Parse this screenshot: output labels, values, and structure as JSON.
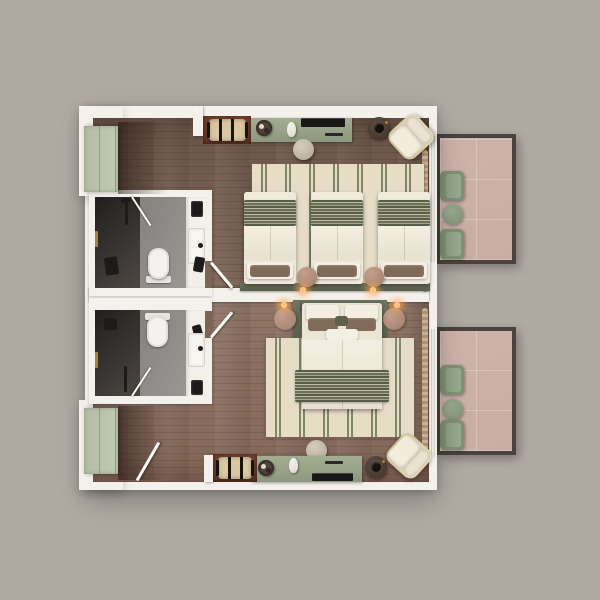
{
  "scene": {
    "kind": "hotel floor plan, top-down 3D render, no text labels",
    "units": [
      {
        "id": "room-upper",
        "type": "triple guestroom",
        "zones": [
          "entry with wardrobe",
          "bathroom",
          "bedroom with three single beds",
          "balcony"
        ],
        "furniture": [
          "luggage-rack",
          "console-desk",
          "tv",
          "coffee-tray",
          "kettle",
          "desk-stool",
          "round-side-table",
          "lounge-chair",
          "striped-area-rug",
          "single-bed",
          "single-bed",
          "single-bed",
          "bedside-pouf",
          "bedside-pouf",
          "wall-lamp",
          "wall-lamp",
          "curtain"
        ],
        "bathroom_fixtures": [
          "walk-in-shower",
          "glass-door",
          "shower-column",
          "towel-rail",
          "black-stool",
          "toilet",
          "vanity-sink",
          "mirror-cabinet",
          "hairdryer"
        ],
        "balcony_furniture": [
          "armchair",
          "armchair",
          "round-table"
        ]
      },
      {
        "id": "room-lower",
        "type": "double guestroom",
        "zones": [
          "entry with wardrobe",
          "bathroom",
          "bedroom with one double bed",
          "balcony"
        ],
        "furniture": [
          "luggage-rack",
          "console-desk",
          "tv",
          "coffee-tray",
          "kettle",
          "desk-stool",
          "round-side-table",
          "lounge-chair",
          "striped-area-rug",
          "double-bed",
          "bedside-table",
          "bedside-table",
          "wall-lamp",
          "wall-lamp",
          "curtain",
          "entry-door"
        ],
        "bathroom_fixtures": [
          "walk-in-shower",
          "glass-door",
          "shower-column",
          "towel-rail",
          "shower-head",
          "toilet",
          "vanity-sink",
          "mirror-cabinet",
          "hairdryer"
        ],
        "balcony_furniture": [
          "armchair",
          "armchair",
          "round-table"
        ]
      }
    ]
  },
  "palette": {
    "bg": "#b0aaa3",
    "wall": "#f4f1ec",
    "wood-hi": "#8d7465",
    "wood-mid": "#7d6455",
    "wood-mid2": "#86695a",
    "wood-lo": "#6d574a",
    "sage-console": "#99a388",
    "sage-closet": "#b8c3a9",
    "sage-dark": "#59614d",
    "sage-chair": "#85977b",
    "cream-bed": "#ece5d4",
    "white-bed": "#f3eee2",
    "pillow-brown": "#806b58",
    "olive-pillow": "#5c6049",
    "rug-cream": "#e7ddc7",
    "rug-stripe": "#7f8769",
    "stripe-dark": "#565e49",
    "stripe-light": "#c3bca3",
    "tile": "#c8ada5",
    "slab": "#49433c",
    "mauve": "#b3907f",
    "walnut": "#4e3f36",
    "ink": "#1d1b19",
    "oxblood": "#6e3b2d",
    "rack-beige": "#d8c7a1",
    "brass": "#a98140",
    "bath-floor": "#8f8b88",
    "porcelain": "#f4f2ee",
    "glow": "#ffbf7d",
    "curtain-a": "#cdb69a",
    "curtain-b": "#ac957c",
    "frame-tan": "#d3c49e"
  }
}
